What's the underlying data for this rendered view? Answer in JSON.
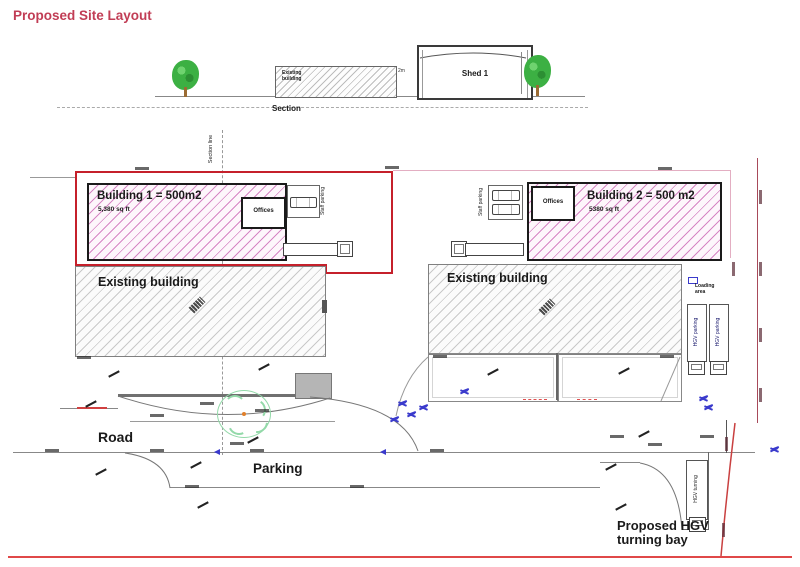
{
  "title": "Proposed Site Layout",
  "colors": {
    "accent_red": "#c13d55",
    "boundary_red": "#c5202b",
    "boundary_pink": "#e3aec2",
    "hatch_pink": "#d685c4",
    "hatch_gray": "#c9c9c9",
    "tree_green": "#3cb043",
    "circle_green": "#93d9a9",
    "mark_blue": "#3a3acc"
  },
  "section_view": {
    "existing_building": "Existing building",
    "shed": "Shed 1",
    "gap_dim": "2m",
    "caption": "Section"
  },
  "plan": {
    "section_line": "Section line",
    "building1": {
      "name": "Building 1 = 500m2",
      "area": "5,380 sq ft",
      "offices": "Offices",
      "staff_parking": "Staff parking"
    },
    "building2": {
      "name": "Building 2 = 500 m2",
      "area": "5380 sq ft",
      "offices": "Offices",
      "staff_parking": "Staff parking"
    },
    "existing_building_left": "Existing building",
    "existing_building_right": "Existing building",
    "loading_area": "Loading area",
    "hgv_parking_1": "HGV parking",
    "hgv_parking_2": "HGV parking",
    "road": "Road",
    "parking": "Parking",
    "hgv_turning": "HGV turning",
    "turning_bay_note": "Proposed HGV turning bay"
  }
}
